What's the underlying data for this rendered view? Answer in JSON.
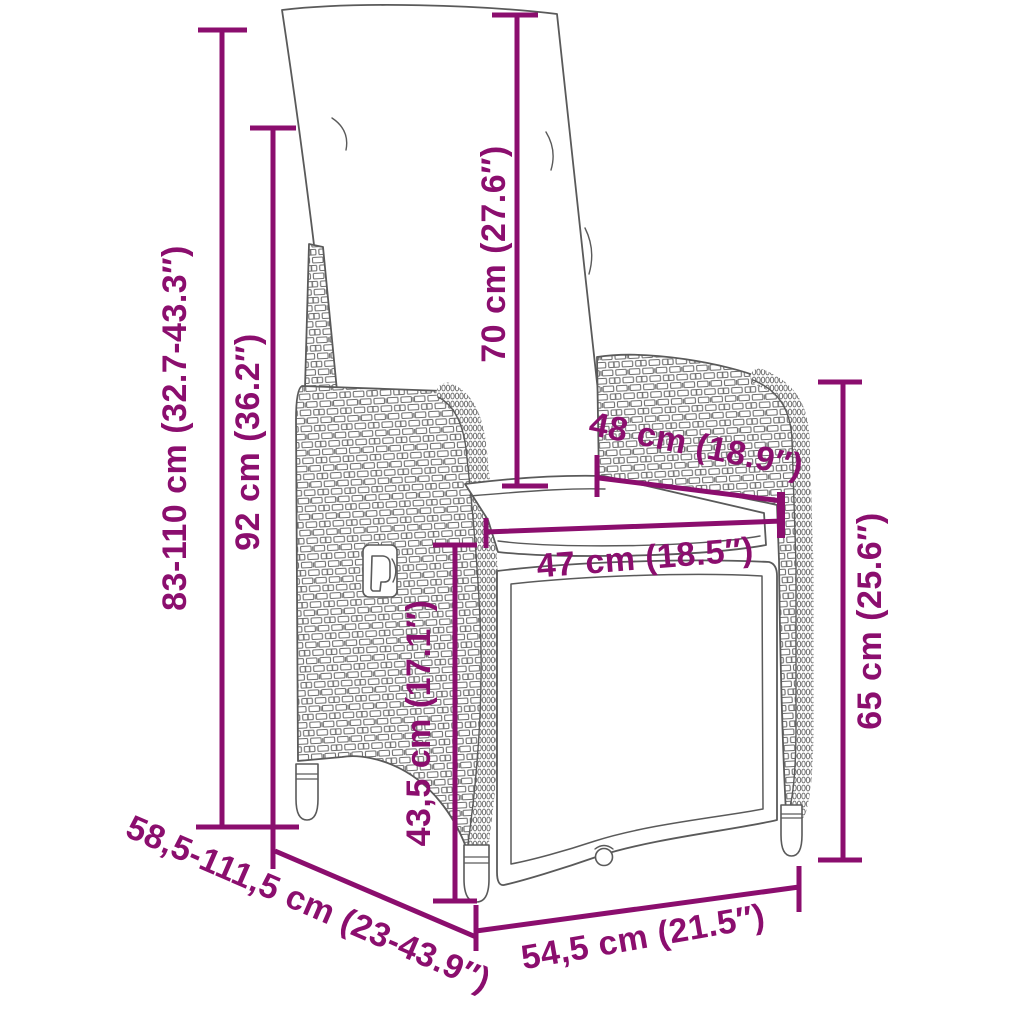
{
  "page": {
    "background_color": "#ffffff",
    "accent_color": "#8b0e6e",
    "outline_color": "#5a5a5a"
  },
  "diagram": {
    "measurements": [
      {
        "id": "total-height-range",
        "label": "83-110 cm (32.7-43.3″)"
      },
      {
        "id": "backrest-height",
        "label": "92 cm (36.2″)"
      },
      {
        "id": "back-cushion-length",
        "label": "70 cm (27.6″)"
      },
      {
        "id": "backrest-width",
        "label": "48 cm (18.9″)"
      },
      {
        "id": "seat-width",
        "label": "47 cm (18.5″)"
      },
      {
        "id": "seat-height",
        "label": "43,5 cm (17.1″)"
      },
      {
        "id": "armrest-height",
        "label": "65 cm (25.6″)"
      },
      {
        "id": "depth-range",
        "label": "58,5-111,5 cm (23-43.9″)"
      },
      {
        "id": "base-width",
        "label": "54,5 cm (21.5″)"
      }
    ]
  }
}
